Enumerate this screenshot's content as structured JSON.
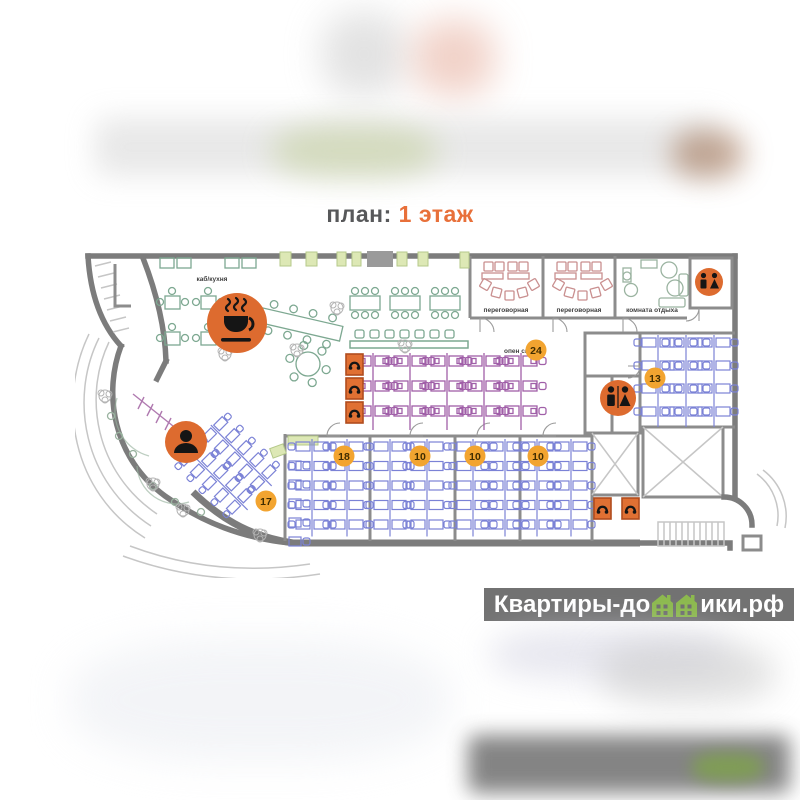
{
  "title": {
    "prefix": "план:",
    "highlight": "1 этаж"
  },
  "floorplan": {
    "room_labels": {
      "kitchen": "каб/кухня",
      "meeting_room_1": "переговорная",
      "meeting_room_2": "переговорная",
      "lounge": "комната отдыха",
      "open_space": "опен спейс"
    },
    "badges": {
      "open_space": "24",
      "office_right": "13",
      "office_18": "18",
      "office_10a": "10",
      "office_10b": "10",
      "office_10c": "10",
      "reception": "17"
    },
    "icons": {
      "coffee_point": "coffee-icon",
      "reception_desk": "person-icon",
      "wc_top_right": "wc-icon",
      "wc_center_right": "wc-icon",
      "phone_booths": "phone-icon"
    },
    "colors": {
      "accent_orange": "#dd6b2f",
      "badge_yellow": "#f2a430",
      "desk_purple": "#a05fa8",
      "desk_blue": "#7b82d6",
      "furniture_green": "#7da891",
      "furniture_pink": "#c98f8f",
      "wall_gray": "#7c7c7c",
      "title_orange": "#e8703a",
      "watermark_green": "#8cb94e"
    }
  },
  "watermark": {
    "part1": "Квартиры-до",
    "part2": "ики.рф"
  }
}
